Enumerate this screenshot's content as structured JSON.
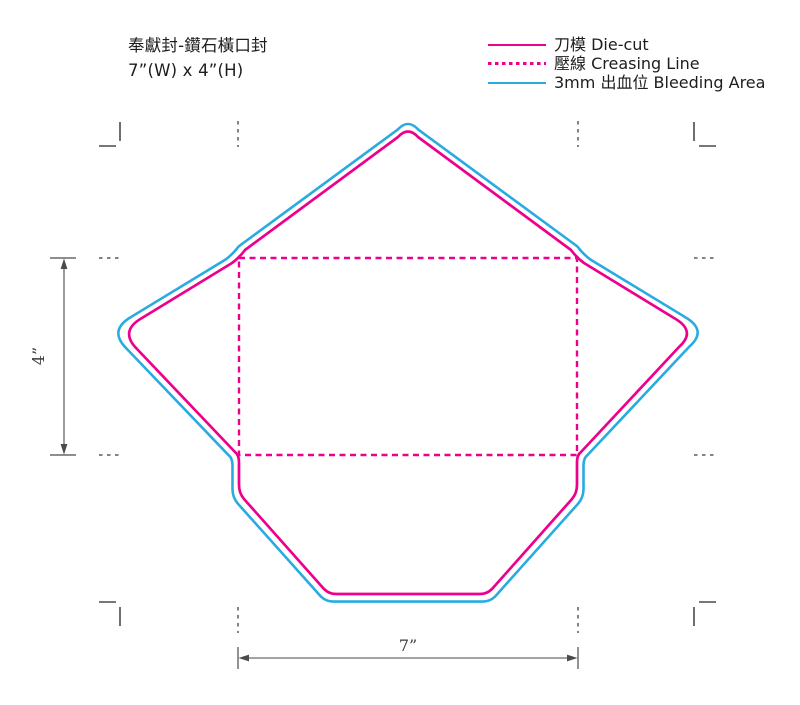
{
  "title": {
    "line1": "奉獻封-鑽石橫口封",
    "line2": "7”(W) x 4”(H)"
  },
  "legend": {
    "items": [
      {
        "label": "刀模  Die-cut",
        "line_style": "solid",
        "color": "#ec008c"
      },
      {
        "label": "壓線  Creasing Line",
        "line_style": "dashed",
        "color": "#ec008c"
      },
      {
        "label": "3mm 出血位 Bleeding Area",
        "line_style": "solid",
        "color": "#29abe2"
      }
    ]
  },
  "diagram": {
    "envelope_type": "diamond-flap horizontal envelope die-line template",
    "width_dimension_label": "7”",
    "height_dimension_label": "4”",
    "colors": {
      "die_cut": "#ec008c",
      "creasing_line": "#ec008c",
      "bleeding_area": "#29abe2",
      "crop_marks": "#4a4a4a",
      "dimension_lines": "#4a4a4a",
      "text": "#1d1d1f"
    }
  }
}
